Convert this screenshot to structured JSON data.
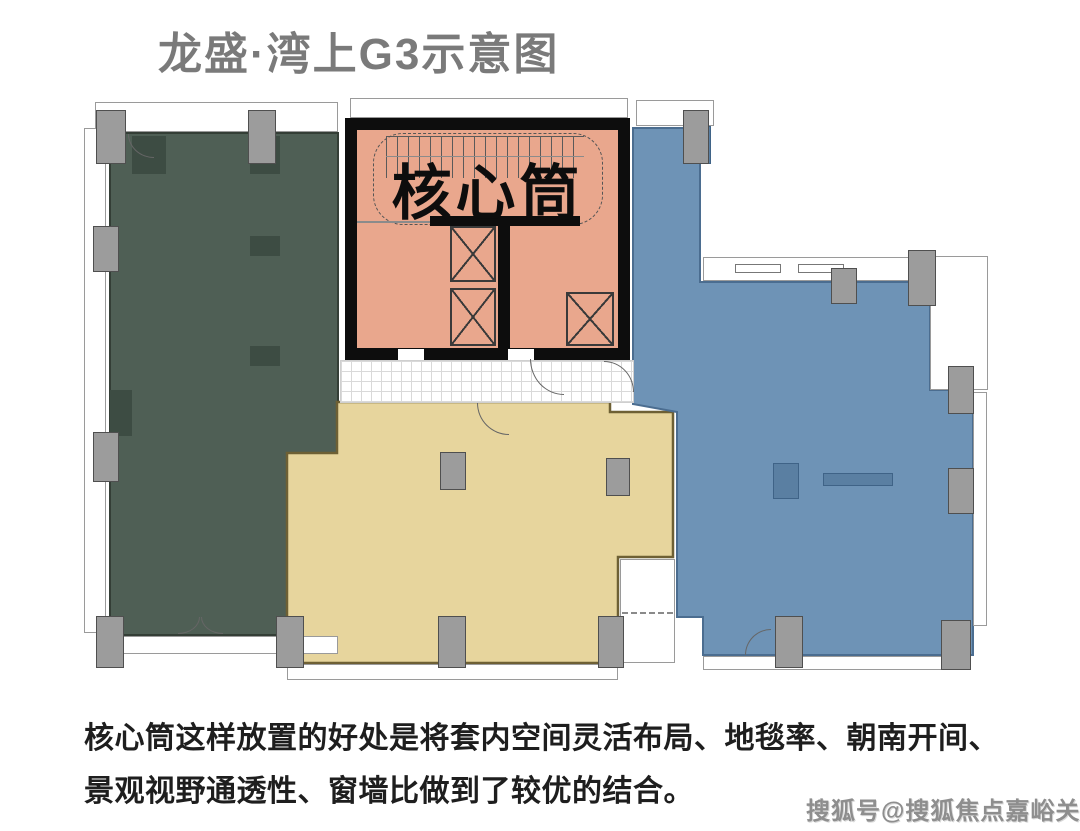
{
  "title": "龙盛·湾上G3示意图",
  "plan": {
    "core_label": "核心筒",
    "colors": {
      "west_zone": "#4f5f55",
      "south_zone": "#e7d59d",
      "east_zone": "#6e93b6",
      "core_zone": "#e9a78d",
      "wall": "#0d0d0d",
      "column": "#9c9c9c"
    }
  },
  "description": {
    "line1": "核心筒这样放置的好处是将套内空间灵活布局、地毯率、朝南开间、",
    "line2": "景观视野通透性、窗墙比做到了较优的结合。"
  },
  "watermark": "搜狐号@搜狐焦点嘉峪关站"
}
